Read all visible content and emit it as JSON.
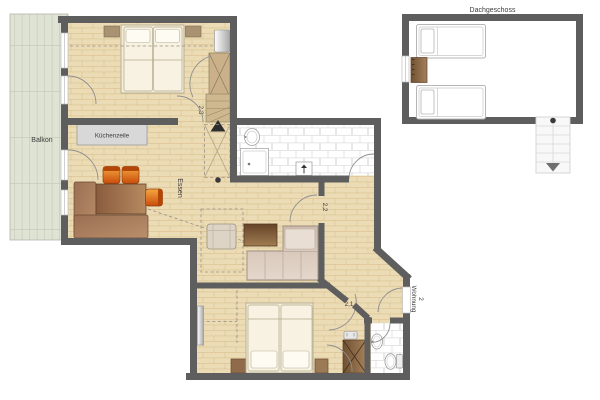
{
  "floorplan": {
    "attic_label": "Dachgeschoss",
    "balcony_label": "Balkon",
    "kitchenette_label": "Küchenzeile",
    "dining_label": "Essen",
    "apartment_label": "Wohnung",
    "apartment_number": "2",
    "room_numbers": {
      "hall": "2,1",
      "living": "2,2",
      "bedroom": "2,3"
    }
  },
  "colors": {
    "wall": "#5e5e5e",
    "wood_floor": "#ecdcb6",
    "wood_line": "#d8c08f",
    "balcony_floor": "#dfe3d3",
    "balcony_line": "#c7cdb9",
    "tile_bg": "#ffffff",
    "tile_line": "#dedede",
    "counter": "#d8d8d8",
    "counter_edge": "#9c9c9c",
    "mattress": "#f7f2e2",
    "bed_line": "#b3ab8f",
    "wardrobe_tan": "#cbb189",
    "wardrobe_line": "#8a7a5a",
    "stair_tan": "#cdb890",
    "dark_marker": "#2e2e2e",
    "text": "#3c3c3c",
    "dash": "#9a9084",
    "door_arc": "#8f8f8f"
  }
}
